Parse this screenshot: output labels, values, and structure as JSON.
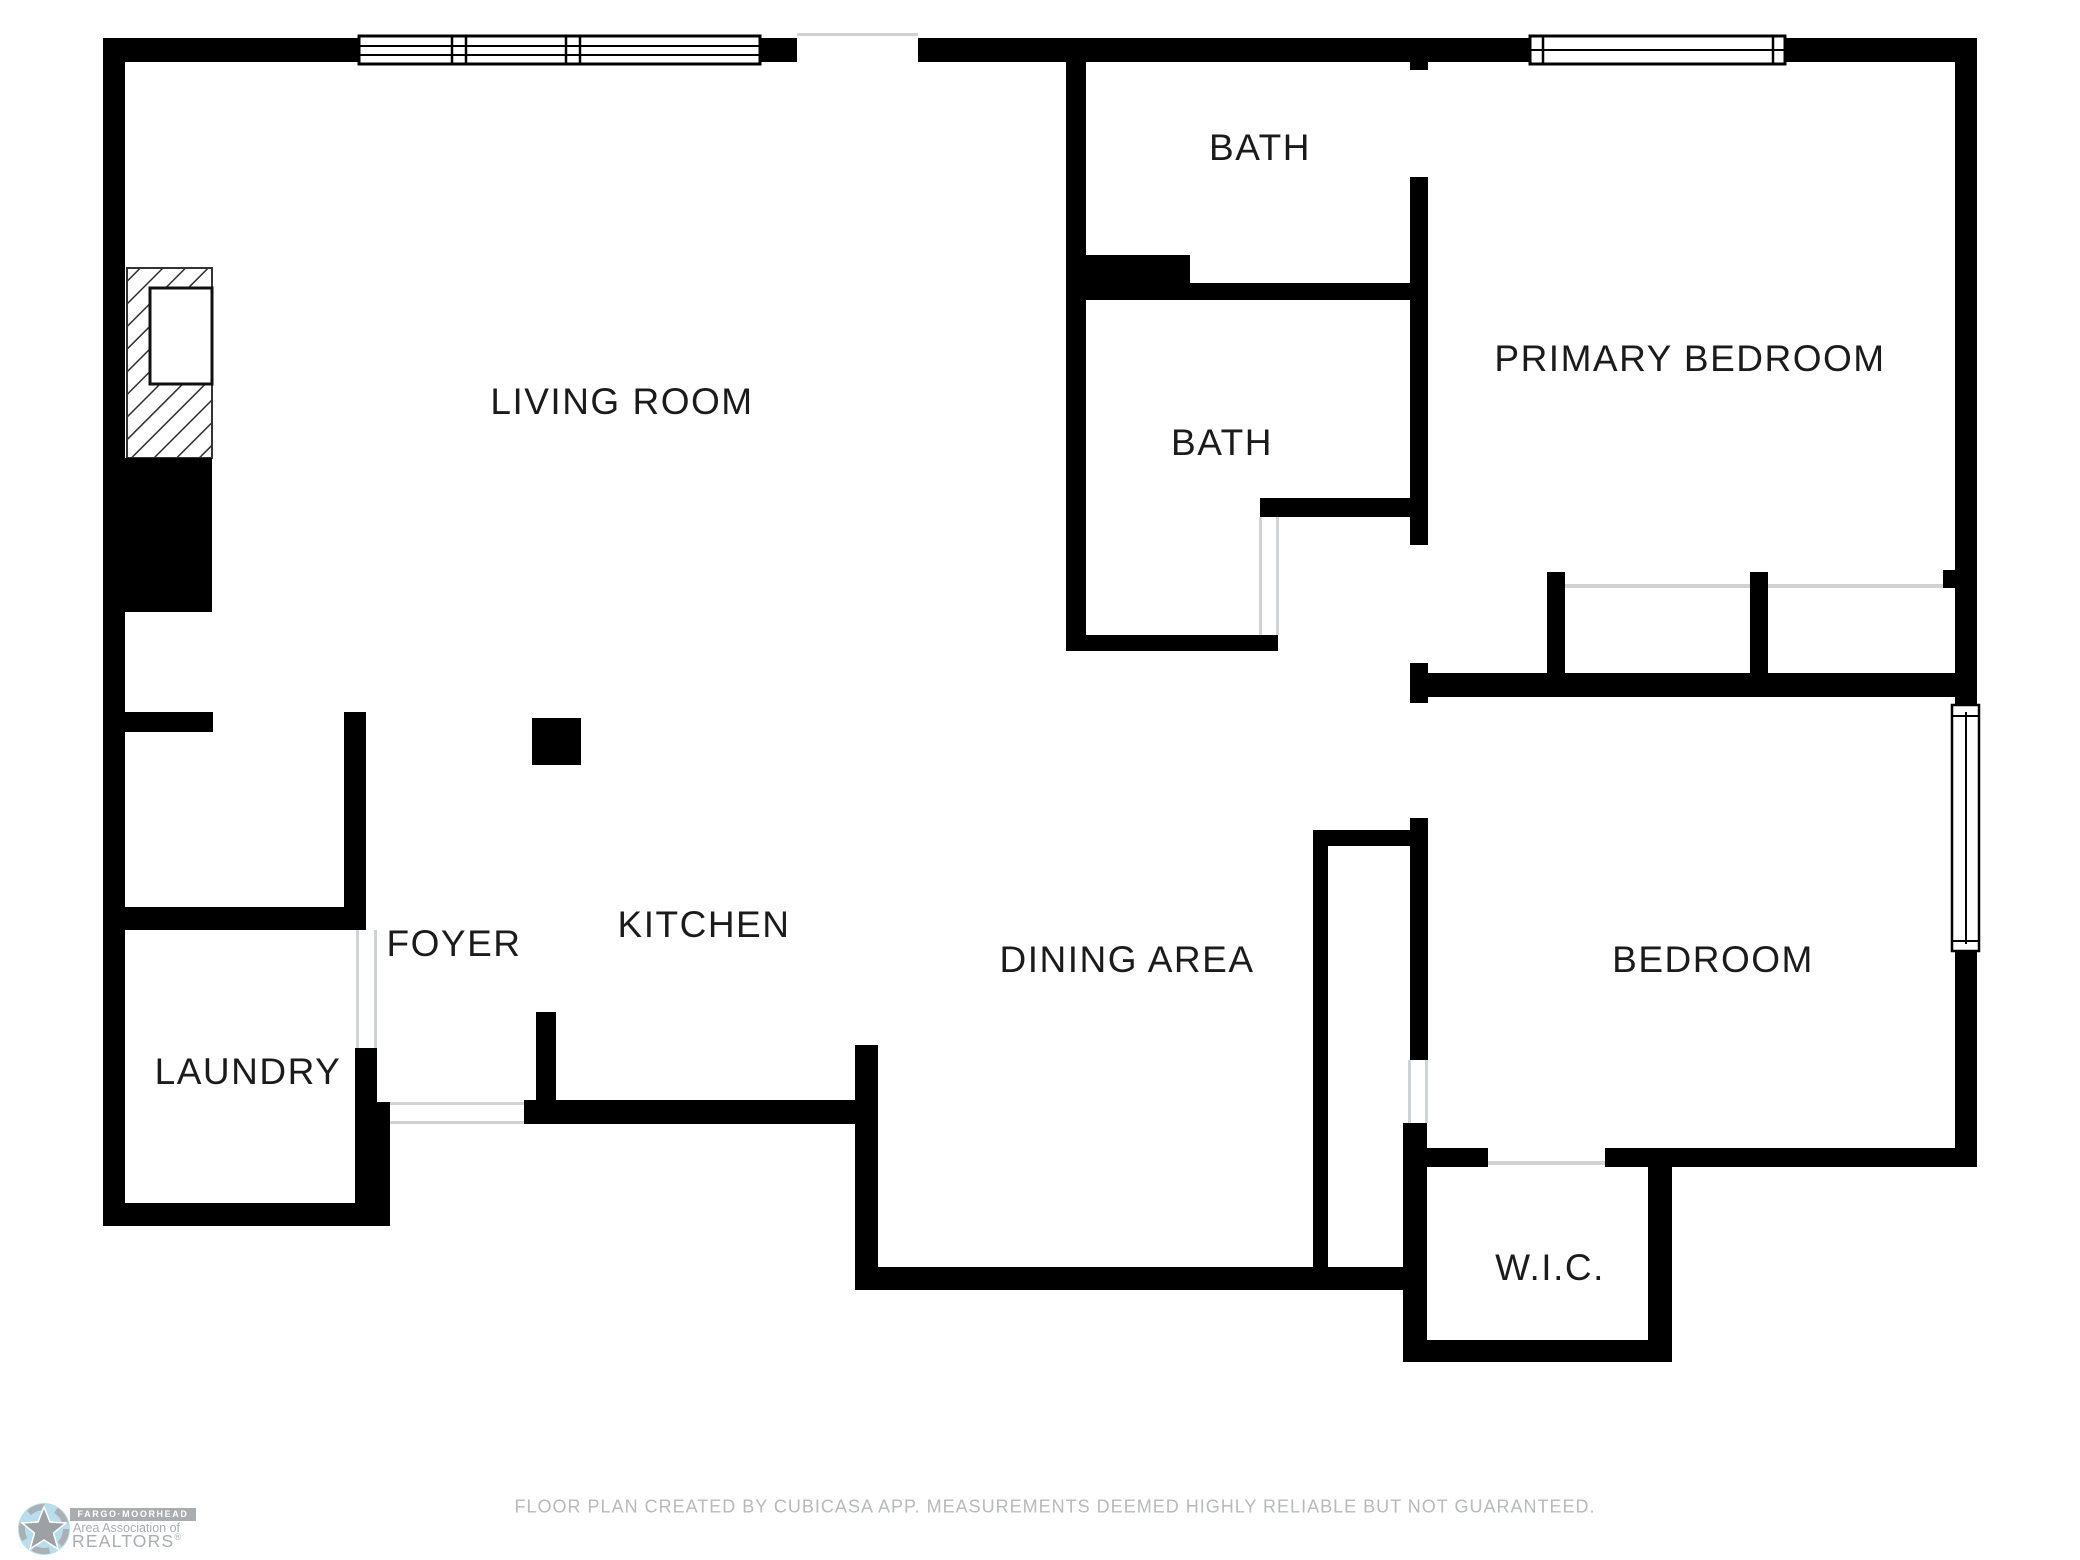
{
  "rooms": {
    "living_room": "LIVING ROOM",
    "bath_top": "BATH",
    "bath_lower": "BATH",
    "primary_bedroom": "PRIMARY BEDROOM",
    "foyer": "FOYER",
    "kitchen": "KITCHEN",
    "dining_area": "DINING AREA",
    "bedroom": "BEDROOM",
    "laundry": "LAUNDRY",
    "wic": "W.I.C."
  },
  "footer": {
    "disclaimer": "FLOOR PLAN CREATED BY CUBICASA APP. MEASUREMENTS DEEMED HIGHLY RELIABLE BUT NOT GUARANTEED."
  },
  "logo": {
    "banner": "FARGO·MOORHEAD",
    "line2": "Area Association of",
    "line3": "REALTORS",
    "registered": "®"
  },
  "colors": {
    "wall": "#000000",
    "label_text": "#1b1b1b",
    "footer_text": "#b7b9bb",
    "thin_line": "#d0d3d5",
    "logo_gray": "#a9adb0",
    "logo_blue": "#b8ddec"
  }
}
